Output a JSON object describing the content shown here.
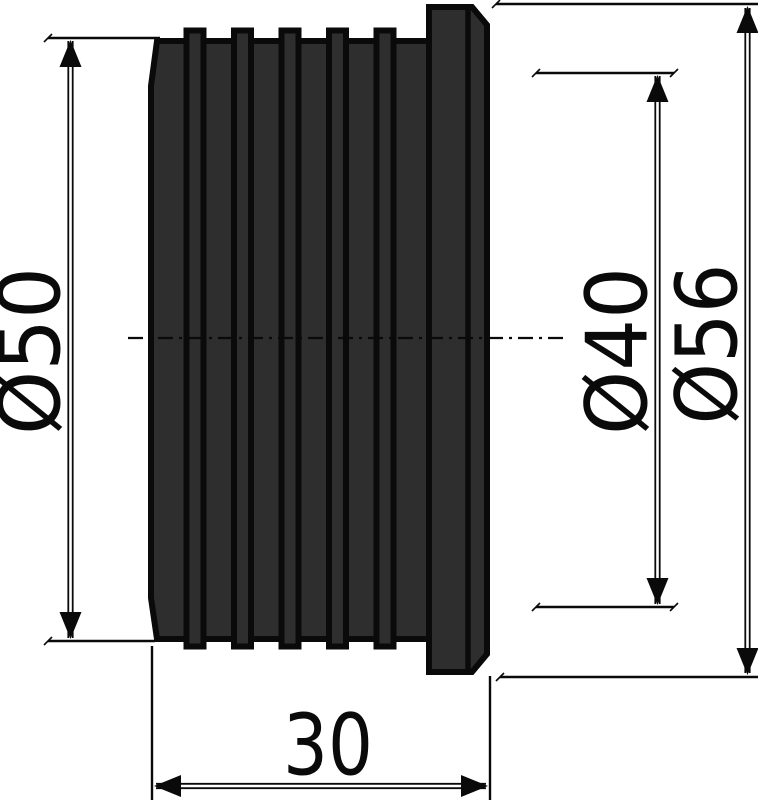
{
  "drawing": {
    "background_color": "#ffffff",
    "line_color": "#0a0a0a",
    "body_fill_color": "#2e2e2e",
    "dimensions": {
      "outer_diameter": {
        "label": "Ø50"
      },
      "inner_diameter": {
        "label": "Ø40"
      },
      "flange_diameter": {
        "label": "Ø56"
      },
      "length": {
        "label": "30"
      }
    }
  }
}
